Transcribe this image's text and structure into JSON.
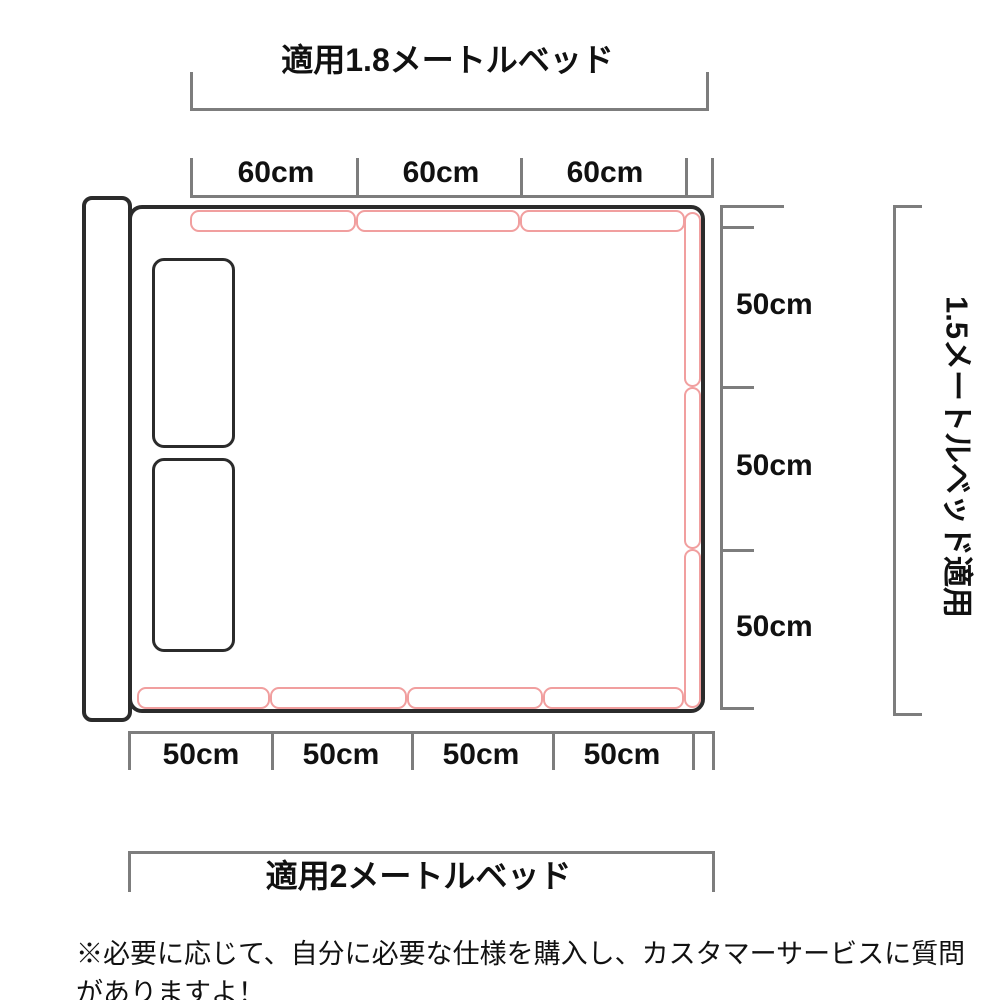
{
  "diagram": {
    "top_label": "適用1.8メートルベッド",
    "bottom_label": "適用2メートルベッド",
    "right_label": "1.5メートルベッド適用",
    "top_dimensions": [
      "60cm",
      "60cm",
      "60cm"
    ],
    "bottom_dimensions": [
      "50cm",
      "50cm",
      "50cm",
      "50cm"
    ],
    "right_dimensions": [
      "50cm",
      "50cm",
      "50cm"
    ],
    "footnote": "※必要に応じて、自分に必要な仕様を購入し、カスタマーサービスに質問がありますよ！",
    "colors": {
      "rail": "#F19F9F",
      "frame": "#2B2B2B",
      "dimension_line": "#7D7D7D",
      "text": "#111111"
    }
  }
}
